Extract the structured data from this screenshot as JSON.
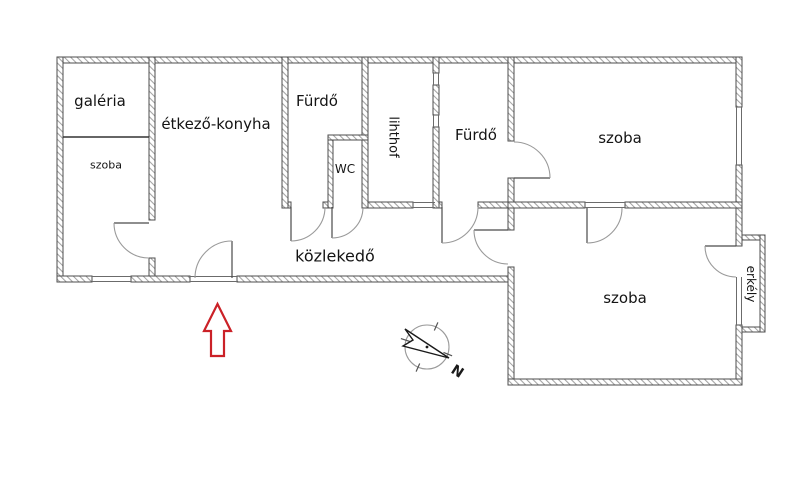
{
  "rooms": {
    "galeria": "galéria",
    "szoba_left": "szoba",
    "etkezo_konyha": "étkező-konyha",
    "furdo_1": "Fürdő",
    "wc": "WC",
    "lihthof": "lihthof",
    "furdo_2": "Fürdő",
    "szoba_top": "szoba",
    "kozlekedo": "közlekedő",
    "szoba_bottom": "szoba",
    "erkely": "erkély"
  },
  "compass": {
    "north_letter": "N"
  },
  "colors": {
    "entrance_arrow": "#cb2127",
    "wall_outline": "#4d4d4d",
    "hatch": "#a3a3a3"
  }
}
